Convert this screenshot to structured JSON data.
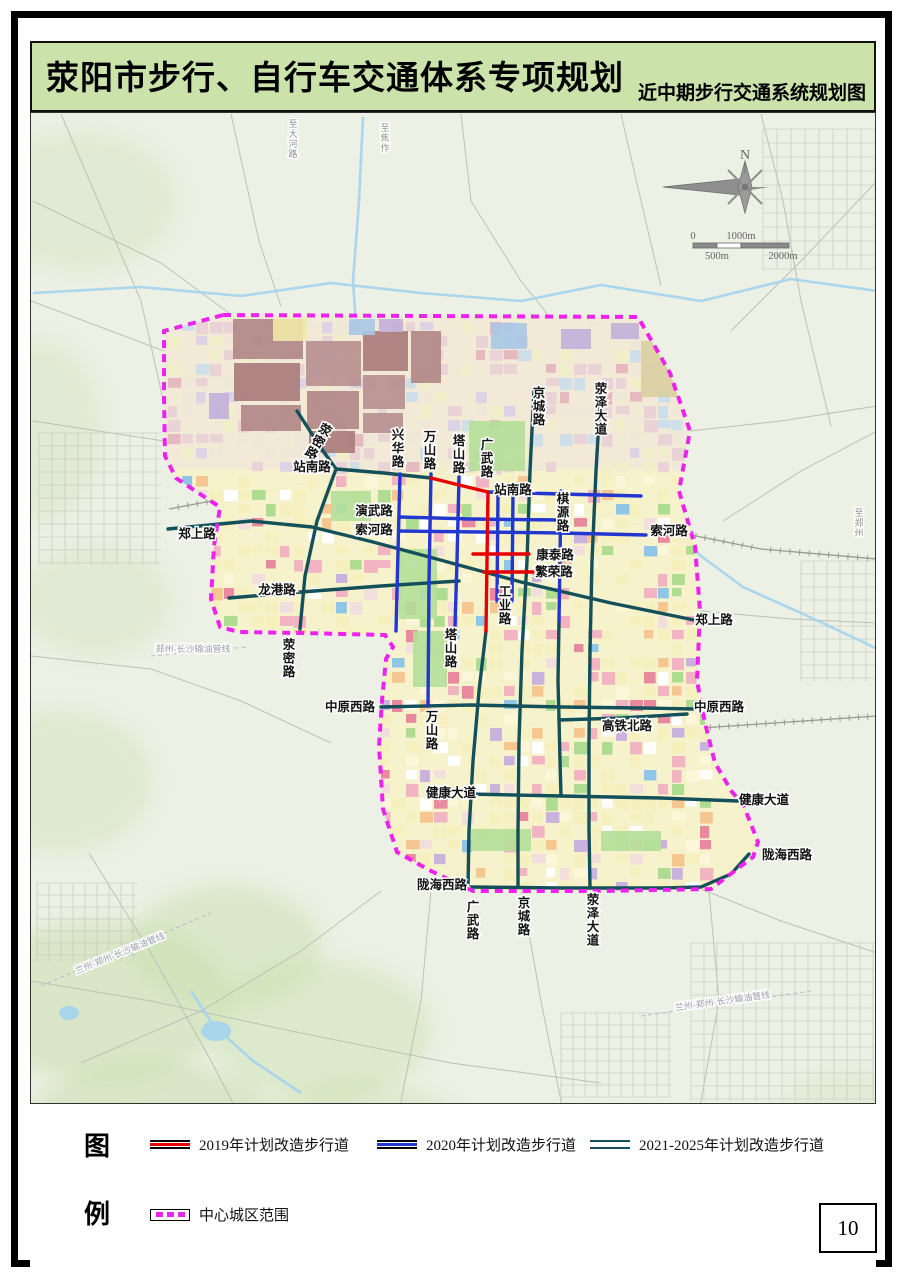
{
  "header": {
    "title": "荥阳市步行、自行车交通体系专项规划",
    "subtitle": "近中期步行交通系统规划图"
  },
  "page_number": "10",
  "legend": {
    "fig_char": "图",
    "li_char": "例",
    "items": [
      {
        "key": "y2019",
        "label": "2019年计划改造步行道"
      },
      {
        "key": "y2020",
        "label": "2020年计划改造步行道"
      },
      {
        "key": "y2021",
        "label": "2021-2025年计划改造步行道"
      },
      {
        "key": "boundary",
        "label": "中心城区范围"
      }
    ]
  },
  "colors": {
    "red": "#e60000",
    "blue": "#2236d0",
    "teal": "#14505a",
    "boundary": "#ee22ee",
    "river": "#a7d4ee",
    "map_bg": "#edf0e4"
  },
  "compass": {
    "north_label": "N"
  },
  "scalebar": {
    "zero": "0",
    "mid_top": "1000m",
    "mid_bottom": "500m",
    "right_bottom": "2000m"
  },
  "map": {
    "boundary_points": [
      [
        222,
        314
      ],
      [
        430,
        315
      ],
      [
        637,
        316
      ],
      [
        669,
        372
      ],
      [
        689,
        430
      ],
      [
        678,
        490
      ],
      [
        694,
        545
      ],
      [
        699,
        610
      ],
      [
        696,
        680
      ],
      [
        704,
        722
      ],
      [
        714,
        762
      ],
      [
        731,
        791
      ],
      [
        742,
        803
      ],
      [
        757,
        841
      ],
      [
        752,
        856
      ],
      [
        710,
        888
      ],
      [
        600,
        890
      ],
      [
        472,
        890
      ],
      [
        428,
        869
      ],
      [
        396,
        851
      ],
      [
        382,
        808
      ],
      [
        378,
        745
      ],
      [
        381,
        700
      ],
      [
        385,
        658
      ],
      [
        392,
        646
      ],
      [
        384,
        634
      ],
      [
        300,
        632
      ],
      [
        238,
        631
      ],
      [
        219,
        626
      ],
      [
        210,
        598
      ],
      [
        213,
        545
      ],
      [
        219,
        506
      ],
      [
        199,
        493
      ],
      [
        175,
        477
      ],
      [
        164,
        455
      ],
      [
        163,
        395
      ],
      [
        163,
        330
      ]
    ],
    "roads": [
      {
        "name": "荥密路北段",
        "color": "teal",
        "pts": [
          [
            296,
            410
          ],
          [
            320,
            447
          ],
          [
            335,
            468
          ]
        ]
      },
      {
        "name": "站南路西段",
        "color": "teal",
        "pts": [
          [
            335,
            468
          ],
          [
            383,
            472
          ],
          [
            430,
            477
          ]
        ]
      },
      {
        "name": "荥密路南段",
        "color": "teal",
        "pts": [
          [
            335,
            468
          ],
          [
            316,
            520
          ],
          [
            304,
            575
          ],
          [
            299,
            628
          ]
        ]
      },
      {
        "name": "郑上路",
        "color": "teal",
        "pts": [
          [
            167,
            528
          ],
          [
            250,
            520
          ],
          [
            311,
            526
          ],
          [
            372,
            541
          ],
          [
            432,
            557
          ],
          [
            520,
            581
          ],
          [
            610,
            602
          ],
          [
            693,
            619
          ]
        ]
      },
      {
        "name": "龙港路",
        "color": "teal",
        "pts": [
          [
            228,
            597
          ],
          [
            300,
            591
          ],
          [
            380,
            585
          ],
          [
            458,
            580
          ]
        ]
      },
      {
        "name": "京城路",
        "color": "teal",
        "pts": [
          [
            533,
            388
          ],
          [
            529,
            470
          ],
          [
            526,
            560
          ],
          [
            521,
            650
          ],
          [
            518,
            740
          ],
          [
            517,
            830
          ],
          [
            517,
            886
          ]
        ]
      },
      {
        "name": "荥泽大道",
        "color": "teal",
        "pts": [
          [
            600,
            385
          ],
          [
            595,
            470
          ],
          [
            591,
            560
          ],
          [
            589,
            650
          ],
          [
            588,
            740
          ],
          [
            588,
            830
          ],
          [
            589,
            886
          ]
        ]
      },
      {
        "name": "塔山路南段",
        "color": "teal",
        "pts": [
          [
            485,
            630
          ],
          [
            478,
            690
          ],
          [
            472,
            760
          ],
          [
            468,
            830
          ],
          [
            467,
            886
          ]
        ]
      },
      {
        "name": "棋源路南段",
        "color": "teal",
        "pts": [
          [
            558,
            620
          ],
          [
            557,
            680
          ],
          [
            558,
            718
          ],
          [
            559,
            760
          ],
          [
            560,
            795
          ]
        ]
      },
      {
        "name": "中原西路",
        "color": "teal",
        "pts": [
          [
            380,
            706
          ],
          [
            470,
            704
          ],
          [
            560,
            706
          ],
          [
            640,
            707
          ],
          [
            693,
            708
          ]
        ]
      },
      {
        "name": "高铁北路",
        "color": "teal",
        "pts": [
          [
            558,
            719
          ],
          [
            620,
            717
          ],
          [
            686,
            713
          ]
        ]
      },
      {
        "name": "健康大道",
        "color": "teal",
        "pts": [
          [
            468,
            793
          ],
          [
            560,
            795
          ],
          [
            660,
            797
          ],
          [
            737,
            800
          ]
        ]
      },
      {
        "name": "陇海西路",
        "color": "teal",
        "pts": [
          [
            470,
            886
          ],
          [
            560,
            887
          ],
          [
            660,
            887
          ],
          [
            700,
            886
          ],
          [
            730,
            873
          ],
          [
            748,
            853
          ]
        ]
      },
      {
        "name": "兴华路",
        "color": "blue",
        "pts": [
          [
            399,
            473
          ],
          [
            397,
            550
          ],
          [
            395,
            630
          ]
        ]
      },
      {
        "name": "万山路",
        "color": "blue",
        "pts": [
          [
            430,
            473
          ],
          [
            428,
            580
          ],
          [
            427,
            705
          ]
        ]
      },
      {
        "name": "塔山路",
        "color": "blue",
        "pts": [
          [
            458,
            476
          ],
          [
            456,
            560
          ],
          [
            454,
            625
          ]
        ]
      },
      {
        "name": "站南路东段",
        "color": "blue",
        "pts": [
          [
            487,
            491
          ],
          [
            560,
            493
          ],
          [
            640,
            495
          ]
        ]
      },
      {
        "name": "演武路",
        "color": "blue",
        "pts": [
          [
            398,
            516
          ],
          [
            470,
            518
          ],
          [
            558,
            519
          ]
        ]
      },
      {
        "name": "索河路",
        "color": "blue",
        "pts": [
          [
            398,
            530
          ],
          [
            480,
            531
          ],
          [
            560,
            532
          ],
          [
            645,
            534
          ]
        ]
      },
      {
        "name": "支路一",
        "color": "blue",
        "pts": [
          [
            497,
            492
          ],
          [
            496,
            600
          ]
        ]
      },
      {
        "name": "支路二",
        "color": "blue",
        "pts": [
          [
            512,
            492
          ],
          [
            511,
            600
          ]
        ]
      },
      {
        "name": "棋源路",
        "color": "blue",
        "pts": [
          [
            560,
            490
          ],
          [
            558,
            620
          ]
        ]
      },
      {
        "name": "站南路改造段",
        "color": "red",
        "pts": [
          [
            430,
            477
          ],
          [
            458,
            484
          ],
          [
            487,
            491
          ]
        ]
      },
      {
        "name": "广武路",
        "color": "red",
        "pts": [
          [
            487,
            491
          ],
          [
            486,
            560
          ],
          [
            485,
            630
          ]
        ]
      },
      {
        "name": "康泰路",
        "color": "red",
        "pts": [
          [
            472,
            553
          ],
          [
            528,
            553
          ]
        ]
      },
      {
        "name": "繁荣路",
        "color": "red",
        "pts": [
          [
            483,
            571
          ],
          [
            535,
            571
          ]
        ]
      }
    ],
    "road_labels": [
      {
        "text": "荥密路",
        "x": 327,
        "y": 424,
        "v": true,
        "rot": 30
      },
      {
        "text": "兴华路",
        "x": 397,
        "y": 428,
        "v": true
      },
      {
        "text": "万山路",
        "x": 429,
        "y": 430,
        "v": true
      },
      {
        "text": "塔山路",
        "x": 458,
        "y": 434,
        "v": true
      },
      {
        "text": "广武路",
        "x": 486,
        "y": 438,
        "v": true
      },
      {
        "text": "京城路",
        "x": 538,
        "y": 386,
        "v": true
      },
      {
        "text": "荥泽大道",
        "x": 600,
        "y": 382,
        "v": true
      },
      {
        "text": "站南路",
        "x": 311,
        "y": 470
      },
      {
        "text": "站南路",
        "x": 512,
        "y": 493
      },
      {
        "text": "演武路",
        "x": 373,
        "y": 514
      },
      {
        "text": "索河路",
        "x": 373,
        "y": 533
      },
      {
        "text": "棋源路",
        "x": 562,
        "y": 492,
        "v": true
      },
      {
        "text": "康泰路",
        "x": 554,
        "y": 558
      },
      {
        "text": "繁荣路",
        "x": 553,
        "y": 575
      },
      {
        "text": "郑上路",
        "x": 196,
        "y": 537
      },
      {
        "text": "郑上路",
        "x": 713,
        "y": 623
      },
      {
        "text": "索河路",
        "x": 668,
        "y": 534
      },
      {
        "text": "龙港路",
        "x": 276,
        "y": 593
      },
      {
        "text": "工业路",
        "x": 504,
        "y": 585,
        "v": true
      },
      {
        "text": "塔山路",
        "x": 450,
        "y": 628,
        "v": true
      },
      {
        "text": "荥密路",
        "x": 288,
        "y": 638,
        "v": true
      },
      {
        "text": "万山路",
        "x": 431,
        "y": 710,
        "v": true
      },
      {
        "text": "中原西路",
        "x": 349,
        "y": 710
      },
      {
        "text": "中原西路",
        "x": 718,
        "y": 710
      },
      {
        "text": "高铁北路",
        "x": 626,
        "y": 729
      },
      {
        "text": "健康大道",
        "x": 450,
        "y": 796
      },
      {
        "text": "健康大道",
        "x": 763,
        "y": 803
      },
      {
        "text": "陇海西路",
        "x": 441,
        "y": 888
      },
      {
        "text": "陇海西路",
        "x": 786,
        "y": 858
      },
      {
        "text": "广武路",
        "x": 472,
        "y": 900,
        "v": true
      },
      {
        "text": "京城路",
        "x": 523,
        "y": 896,
        "v": true
      },
      {
        "text": "荥泽大道",
        "x": 592,
        "y": 893,
        "v": true
      }
    ],
    "small_labels": [
      {
        "text": "至大河路",
        "x": 292,
        "y": 116,
        "v": true
      },
      {
        "text": "至焦作",
        "x": 384,
        "y": 120,
        "v": true
      },
      {
        "text": "至郑州",
        "x": 858,
        "y": 505,
        "v": true
      }
    ],
    "pipeline_labels": [
      {
        "text": "郑州-长沙输油管线",
        "x": 192,
        "y": 651,
        "rot": 0
      },
      {
        "text": "兰州-郑州-长沙输油管线",
        "x": 120,
        "y": 955,
        "rot": -22
      },
      {
        "text": "兰州-郑州-长沙输油管线",
        "x": 722,
        "y": 1003,
        "rot": -8
      }
    ]
  }
}
